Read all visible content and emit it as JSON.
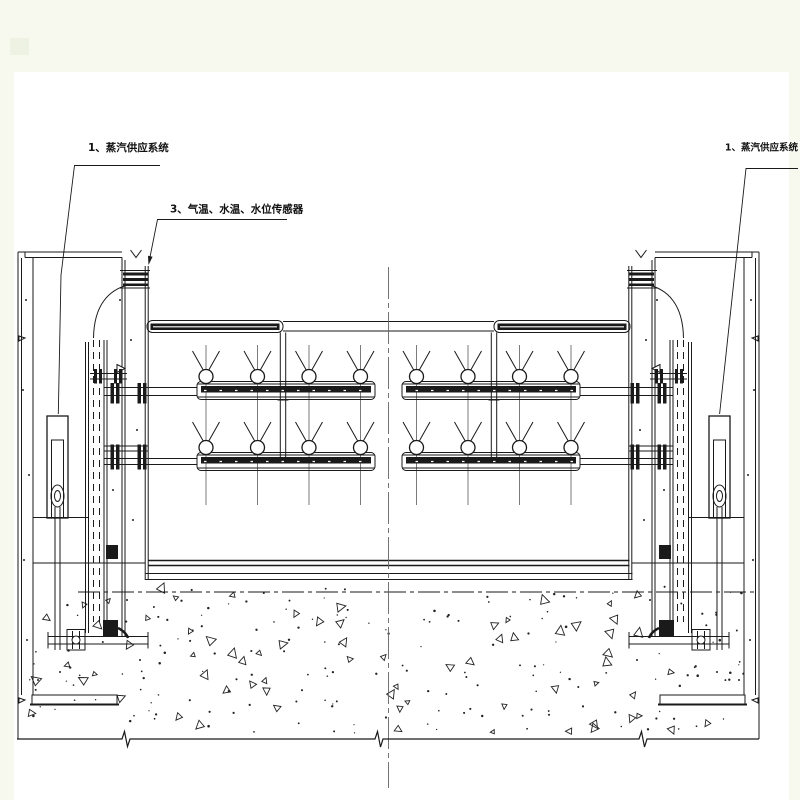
{
  "drawing": {
    "labels": {
      "steam_supply_left": "1、蒸汽供应系统",
      "sensors": "3、气温、水温、水位传感器",
      "steam_supply_right": "1、蒸汽供应系统"
    },
    "colors": {
      "canvas": "#f7f8ee",
      "sheet": "#ffffff",
      "line": "#1a1a1a",
      "marker": "#edf2e2"
    }
  }
}
